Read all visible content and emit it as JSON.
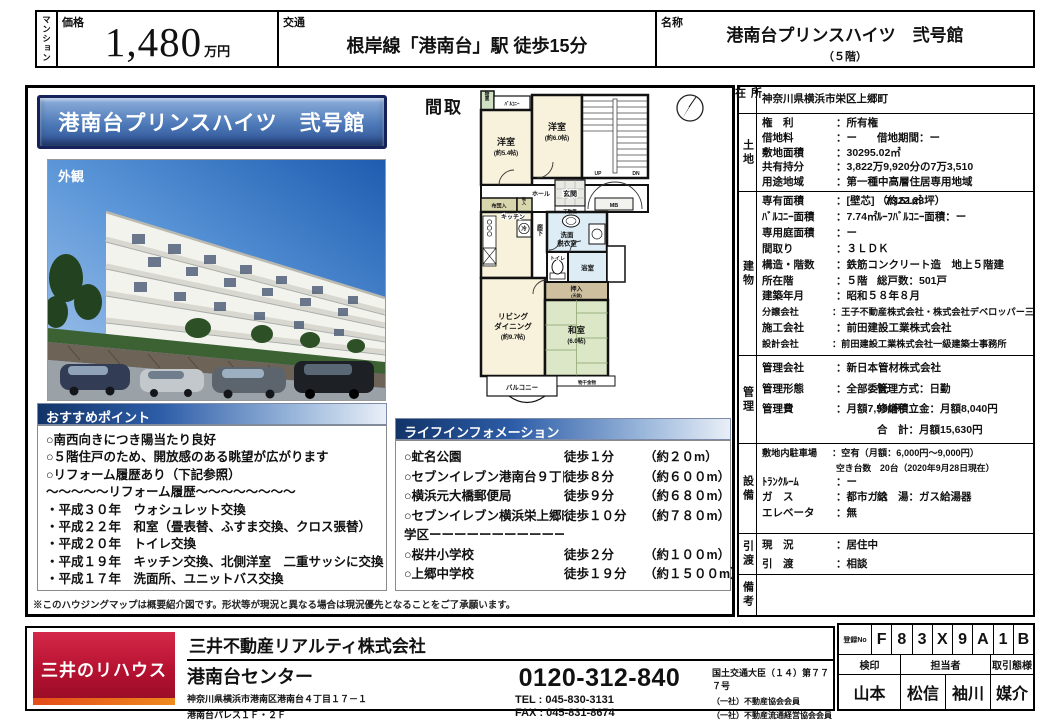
{
  "header": {
    "category": "マンション",
    "price_label": "価格",
    "price_value": "1,480",
    "price_unit": "万円",
    "transport_label": "交通",
    "transport_value": "根岸線「港南台」駅 徒歩15分",
    "name_label": "名称",
    "name_value": "港南台プリンスハイツ　弐号館",
    "name_floor": "（５階）"
  },
  "left": {
    "banner": "港南台プリンスハイツ　弐号館",
    "photo_label": "外観",
    "points_title": "おすすめポイント",
    "points": [
      "○南西向きにつき陽当たり良好",
      "○５階住戸のため、開放感のある眺望が広がります",
      "○リフォーム履歴あり（下記参照）",
      "～～～～～リフォーム履歴～～～～～～～～",
      "・平成３０年　ウォシュレット交換",
      "・平成２２年　和室（畳表替、ふすま交換、クロス張替）",
      "・平成２０年　トイレ交換",
      "・平成１９年　キッチン交換、北側洋室　二重サッシに交換",
      "・平成１７年　洗面所、ユニットバス交換"
    ],
    "note": "※このハウジングマップは概要紹介図です。形状等が現況と異なる場合は現況優先となることをご了承願います。"
  },
  "floorplan": {
    "title": "間取",
    "labels": {
      "storage": "物置",
      "balcony_top": "ﾊﾞﾙｺﾆｰ",
      "western1": "洋室",
      "western1_size": "(約5.4帖)",
      "western2": "洋室",
      "western2_size": "(約6.0帖)",
      "up": "UP",
      "dn": "DN",
      "hall": "ホール",
      "entrance": "玄関",
      "shoebox": "下駄箱",
      "mb": "MB",
      "futon": "布団入",
      "mono": "物入",
      "kitchen": "キッチン",
      "fridge": "冷",
      "corridor": "廊下",
      "wash1": "洗面",
      "wash2": "脱衣室",
      "toilet": "トイレ",
      "bath": "浴室",
      "oshiire": "押入",
      "oshiire_sub": "(天袋)",
      "living1": "リビング",
      "living2": "ダイニング",
      "living3": "(約9.7帖)",
      "washitsu": "和室",
      "washitsu_size": "(6.0帖)",
      "balcony_bottom": "バルコニー",
      "hanger": "物干金物"
    }
  },
  "lifeinfo": {
    "title": "ライフインフォメーション",
    "items": [
      {
        "name": "○虻名公園",
        "walk": "徒歩１分",
        "dist": "（約２０m）"
      },
      {
        "name": "○セブンイレブン港南台９丁目店",
        "walk": "徒歩８分",
        "dist": "（約６００m）"
      },
      {
        "name": "○横浜元大橋郵便局",
        "walk": "徒歩９分",
        "dist": "（約６８０m）"
      },
      {
        "name": "○セブンイレブン横浜栄上郷町店",
        "walk": "徒歩１０分",
        "dist": "（約７８０m）"
      },
      {
        "name": "学区ーーーーーーーーーーーーーーーーーー",
        "walk": "",
        "dist": ""
      },
      {
        "name": "○桜井小学校",
        "walk": "徒歩２分",
        "dist": "（約１００m）"
      },
      {
        "name": "○上郷中学校",
        "walk": "徒歩１９分",
        "dist": "（約１５００m）"
      }
    ]
  },
  "details": {
    "shozai_label": "所在",
    "shozai_rows": [
      {
        "k": "",
        "v": "神奈川県横浜市栄区上郷町"
      }
    ],
    "tochi_label": "土地",
    "tochi_rows": [
      {
        "k": "権　利",
        "v": "：所有権"
      },
      {
        "k": "借地料",
        "v": "：ー",
        "k2": "借地期間",
        "v2": "：ー"
      },
      {
        "k": "敷地面積",
        "v": "：30295.02㎡"
      },
      {
        "k": "共有持分",
        "v": "：3,822万9,920分の7万3,510"
      },
      {
        "k": "用途地域",
        "v": "：第一種中高層住居専用地域"
      }
    ],
    "tatemono_label": "建物",
    "tatemono_rows": [
      {
        "k": "専有面積",
        "v": "：[壁芯]　73.51㎡",
        "k2": "",
        "v2": "（約22.23坪）"
      },
      {
        "k": "ﾊﾞﾙｺﾆｰ面積",
        "v": "：7.74㎡",
        "k2": "ﾙｰﾌﾊﾞﾙｺﾆｰ面積",
        "v2": "：ー"
      },
      {
        "k": "専用庭面積",
        "v": "：ー"
      },
      {
        "k": "間取り",
        "v": "：３ＬＤＫ"
      },
      {
        "k": "構造・階数",
        "v": "：鉄筋コンクリート造　地上５階建"
      },
      {
        "k": "所在階",
        "v": "：５階",
        "k2": "総戸数",
        "v2": "：501戸"
      },
      {
        "k": "建築年月",
        "v": "：昭和５８年８月"
      },
      {
        "k": "分譲会社",
        "v": "：王子不動産株式会社・株式会社デベロッパー三信",
        "cls": "sm"
      },
      {
        "k": "施工会社",
        "v": "：前田建設工業株式会社"
      },
      {
        "k": "設計会社",
        "v": "：前田建設工業株式会社一級建築士事務所",
        "cls": "sm"
      }
    ],
    "kanri_label": "管理",
    "kanri_rows": [
      {
        "k": "管理会社",
        "v": "：新日本管材株式会社"
      },
      {
        "k": "管理形態",
        "v": "：全部委託",
        "k2": "管理方式",
        "v2": "：日勤"
      },
      {
        "k": "管理費",
        "v": "：月額7,590円",
        "k2": "修繕積立金",
        "v2": "：月額8,040円"
      },
      {
        "k": "",
        "v": "",
        "k2": "合　計",
        "v2": "：月額15,630円"
      }
    ],
    "setsubi_label": "設備",
    "setsubi_rows": [
      {
        "k": "敷地内駐車場",
        "v": "：空有（月額：6,000円～9,000円）",
        "cls": "sm",
        "note": "空き台数　20台（2020年9月28日現在）"
      },
      {
        "k": "ﾄﾗﾝｸﾙｰﾑ",
        "v": "：ー"
      },
      {
        "k": "ガ　ス",
        "v": "：都市ガス",
        "k2": "給　湯",
        "v2": "：ガス給湯器"
      },
      {
        "k": "エレベータ",
        "v": "：無"
      }
    ],
    "hikiwatashi_label": "引渡",
    "hikiwatashi_rows": [
      {
        "k": "現　況",
        "v": "：居住中"
      },
      {
        "k": "引　渡",
        "v": "：相談"
      }
    ],
    "biko_label": "備考"
  },
  "footer": {
    "logo_text": "三井のリハウス",
    "company": "三井不動産リアルティ株式会社",
    "center": "港南台センター",
    "address1": "神奈川県横浜市港南区港南台４丁目１７－１",
    "address2": "港南台パレス１Ｆ・２Ｆ",
    "phone": "0120-312-840",
    "tel": "TEL : 045-830-3131",
    "fax": "FAX : 045-831-8674",
    "license": "国土交通大臣（１４）第７７７号",
    "memberships": [
      "（一社）不動産協会会員",
      "（一社）不動産流通経営協会会員",
      "（公社）首都圏不動産公正取引協議会加盟"
    ],
    "reg_label": "登録No",
    "reg_chars": [
      "F",
      "8",
      "3",
      "X",
      "9",
      "A",
      "1",
      "B"
    ],
    "col_kenin": "検印",
    "col_tanto": "担当者",
    "col_torihiki": "取引態様",
    "kenin_name": "山本",
    "tanto_names": [
      "松信",
      "袖川"
    ],
    "torihiki_value": "媒介"
  }
}
